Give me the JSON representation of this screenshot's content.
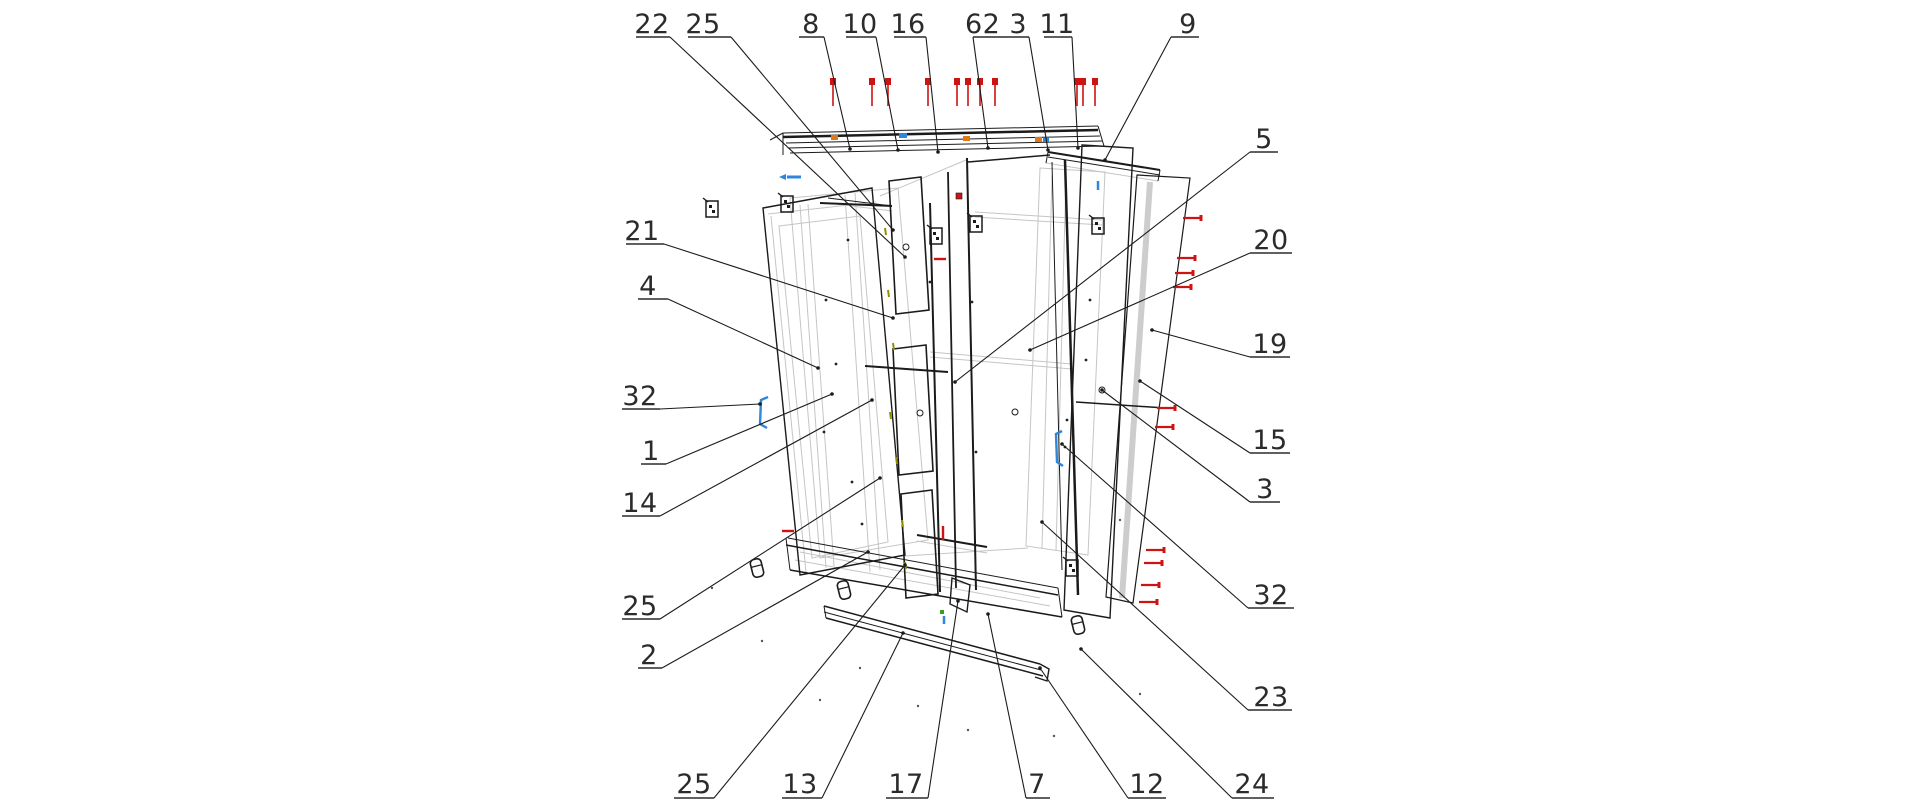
{
  "meta": {
    "width": 1916,
    "height": 804,
    "description": "Exploded assembly diagram of a sliding-door wardrobe cabinet with numbered part callouts"
  },
  "palette": {
    "line": "#1b1b1b",
    "ghost": "#c5c5c5",
    "band": "#cdcdcd",
    "red": "#cc1414",
    "blue": "#2e86de",
    "orange": "#e07818",
    "olive": "#8f9000",
    "green": "#3a9d23",
    "label": "#2b2b2b"
  },
  "callouts": [
    {
      "label": "22",
      "tx": 652,
      "ty": 33,
      "ul": [
        636,
        670,
        37
      ],
      "leaders": [
        [
          670,
          37,
          905,
          257
        ]
      ]
    },
    {
      "label": "25",
      "tx": 703,
      "ty": 33,
      "ul": [
        688,
        731,
        37
      ],
      "leaders": [
        [
          731,
          37,
          893,
          230
        ]
      ]
    },
    {
      "label": "8",
      "tx": 811,
      "ty": 33,
      "ul": [
        799,
        824,
        37
      ],
      "leaders": [
        [
          824,
          37,
          850,
          149
        ]
      ]
    },
    {
      "label": "10",
      "tx": 860,
      "ty": 33,
      "ul": [
        846,
        876,
        37
      ],
      "leaders": [
        [
          876,
          37,
          898,
          150
        ]
      ]
    },
    {
      "label": "16",
      "tx": 908,
      "ty": 33,
      "ul": [
        894,
        926,
        37
      ],
      "leaders": [
        [
          926,
          37,
          938,
          152
        ]
      ]
    },
    {
      "label": "62 3",
      "tx": 996,
      "ty": 33,
      "ul": [
        973,
        1029,
        37
      ],
      "leaders": [
        [
          973,
          37,
          988,
          148
        ],
        [
          1029,
          37,
          1048,
          150
        ]
      ]
    },
    {
      "label": "11",
      "tx": 1057,
      "ty": 33,
      "ul": [
        1044,
        1072,
        37
      ],
      "leaders": [
        [
          1072,
          37,
          1078,
          148
        ]
      ]
    },
    {
      "label": "9",
      "tx": 1188,
      "ty": 33,
      "ul": [
        1171,
        1199,
        37
      ],
      "leaders": [
        [
          1171,
          37,
          1105,
          160
        ]
      ]
    },
    {
      "label": "21",
      "tx": 642,
      "ty": 240,
      "ul": [
        626,
        664,
        244
      ],
      "leaders": [
        [
          664,
          244,
          893,
          318
        ]
      ]
    },
    {
      "label": "4",
      "tx": 648,
      "ty": 295,
      "ul": [
        638,
        668,
        299
      ],
      "leaders": [
        [
          668,
          299,
          818,
          368
        ]
      ]
    },
    {
      "label": "32",
      "tx": 640,
      "ty": 405,
      "ul": [
        622,
        660,
        409
      ],
      "leaders": [
        [
          660,
          409,
          760,
          404
        ]
      ]
    },
    {
      "label": "1",
      "tx": 651,
      "ty": 460,
      "ul": [
        641,
        666,
        464
      ],
      "leaders": [
        [
          666,
          464,
          832,
          394
        ]
      ]
    },
    {
      "label": "14",
      "tx": 640,
      "ty": 512,
      "ul": [
        622,
        660,
        516
      ],
      "leaders": [
        [
          660,
          516,
          872,
          400
        ]
      ]
    },
    {
      "label": "25",
      "tx": 640,
      "ty": 615,
      "ul": [
        622,
        660,
        619
      ],
      "leaders": [
        [
          660,
          619,
          880,
          478
        ]
      ]
    },
    {
      "label": "2",
      "tx": 649,
      "ty": 664,
      "ul": [
        638,
        662,
        668
      ],
      "leaders": [
        [
          662,
          668,
          868,
          552
        ]
      ]
    },
    {
      "label": "5",
      "tx": 1264,
      "ty": 148,
      "ul": [
        1250,
        1278,
        152
      ],
      "leaders": [
        [
          1250,
          152,
          955,
          382
        ]
      ]
    },
    {
      "label": "20",
      "tx": 1271,
      "ty": 249,
      "ul": [
        1250,
        1292,
        253
      ],
      "leaders": [
        [
          1250,
          253,
          1030,
          350
        ]
      ]
    },
    {
      "label": "19",
      "tx": 1270,
      "ty": 353,
      "ul": [
        1250,
        1290,
        357
      ],
      "leaders": [
        [
          1250,
          357,
          1152,
          330
        ]
      ]
    },
    {
      "label": "15",
      "tx": 1270,
      "ty": 449,
      "ul": [
        1250,
        1290,
        453
      ],
      "leaders": [
        [
          1250,
          453,
          1140,
          381
        ]
      ]
    },
    {
      "label": "3",
      "tx": 1265,
      "ty": 498,
      "ul": [
        1250,
        1280,
        502
      ],
      "leaders": [
        [
          1250,
          502,
          1102,
          390
        ]
      ]
    },
    {
      "label": "32",
      "tx": 1271,
      "ty": 604,
      "ul": [
        1248,
        1294,
        608
      ],
      "leaders": [
        [
          1248,
          608,
          1062,
          444
        ]
      ]
    },
    {
      "label": "23",
      "tx": 1271,
      "ty": 706,
      "ul": [
        1248,
        1292,
        710
      ],
      "leaders": [
        [
          1248,
          710,
          1042,
          522
        ]
      ]
    },
    {
      "label": "25",
      "tx": 694,
      "ty": 793,
      "ul": [
        674,
        714,
        798
      ],
      "leaders": [
        [
          714,
          798,
          905,
          565
        ]
      ]
    },
    {
      "label": "13",
      "tx": 800,
      "ty": 793,
      "ul": [
        782,
        822,
        798
      ],
      "leaders": [
        [
          822,
          798,
          903,
          633
        ]
      ]
    },
    {
      "label": "17",
      "tx": 906,
      "ty": 793,
      "ul": [
        886,
        928,
        798
      ],
      "leaders": [
        [
          928,
          798,
          958,
          601
        ]
      ]
    },
    {
      "label": "7",
      "tx": 1037,
      "ty": 793,
      "ul": [
        1026,
        1050,
        798
      ],
      "leaders": [
        [
          1026,
          798,
          988,
          614
        ]
      ]
    },
    {
      "label": "12",
      "tx": 1147,
      "ty": 793,
      "ul": [
        1128,
        1166,
        798
      ],
      "leaders": [
        [
          1128,
          798,
          1040,
          668
        ]
      ]
    },
    {
      "label": "24",
      "tx": 1252,
      "ty": 793,
      "ul": [
        1232,
        1274,
        798
      ],
      "leaders": [
        [
          1232,
          798,
          1081,
          649
        ]
      ]
    }
  ],
  "drawing": {
    "ghost_polys": [
      {
        "name": "left-door-back-panel",
        "pts": [
          [
            790,
            198
          ],
          [
            898,
            188
          ],
          [
            928,
            540
          ],
          [
            820,
            558
          ]
        ],
        "w": 1
      },
      {
        "name": "left-door-inner-frame",
        "pts": [
          [
            779,
            226
          ],
          [
            860,
            216
          ],
          [
            888,
            542
          ],
          [
            812,
            558
          ]
        ],
        "w": 1
      },
      {
        "name": "right-back-panel",
        "pts": [
          [
            1040,
            168
          ],
          [
            1105,
            172
          ],
          [
            1088,
            555
          ],
          [
            1026,
            546
          ]
        ],
        "w": 1
      }
    ],
    "ghost_lines": [
      [
        771,
        216,
        806,
        572,
        1
      ],
      [
        768,
        214,
        876,
        202,
        1
      ],
      [
        800,
        205,
        826,
        568,
        1
      ],
      [
        808,
        204,
        834,
        566,
        1
      ],
      [
        845,
        195,
        870,
        572,
        1
      ],
      [
        855,
        193,
        880,
        570,
        1
      ],
      [
        880,
        196,
        966,
        160,
        1
      ],
      [
        905,
        556,
        1028,
        548,
        1
      ],
      [
        930,
        352,
        1072,
        364,
        1
      ],
      [
        930,
        357,
        1072,
        369,
        1
      ],
      [
        975,
        212,
        1102,
        220,
        1
      ],
      [
        975,
        217,
        1102,
        225,
        1
      ],
      [
        1052,
        175,
        1042,
        548,
        1
      ],
      [
        1066,
        176,
        1056,
        550,
        1
      ],
      [
        800,
        552,
        1040,
        598,
        1
      ],
      [
        795,
        560,
        1050,
        606,
        1
      ],
      [
        828,
        203,
        892,
        211,
        1
      ],
      [
        917,
        541,
        987,
        553,
        1
      ],
      [
        1150,
        182,
        1122,
        598,
        6
      ],
      [
        1046,
        163,
        1158,
        181,
        1
      ]
    ],
    "polys": [
      {
        "name": "left-side-panel",
        "pts": [
          [
            763,
            208
          ],
          [
            872,
            188
          ],
          [
            905,
            555
          ],
          [
            800,
            575
          ]
        ],
        "w": 1.4
      },
      {
        "name": "filler-panel-top",
        "pts": [
          [
            889,
            181
          ],
          [
            921,
            177
          ],
          [
            929,
            310
          ],
          [
            896,
            314
          ]
        ],
        "w": 1.6
      },
      {
        "name": "filler-panel-mid",
        "pts": [
          [
            893,
            349
          ],
          [
            926,
            345
          ],
          [
            933,
            471
          ],
          [
            899,
            475
          ]
        ],
        "w": 1.6
      },
      {
        "name": "filler-panel-bottom",
        "pts": [
          [
            901,
            494
          ],
          [
            932,
            490
          ],
          [
            938,
            594
          ],
          [
            906,
            598
          ]
        ],
        "w": 1.6
      },
      {
        "name": "right-side-panel",
        "pts": [
          [
            1082,
            145
          ],
          [
            1133,
            148
          ],
          [
            1110,
            618
          ],
          [
            1064,
            610
          ]
        ],
        "w": 1.4
      },
      {
        "name": "right-door-panel",
        "pts": [
          [
            1137,
            175
          ],
          [
            1190,
            178
          ],
          [
            1133,
            603
          ],
          [
            1106,
            597
          ]
        ],
        "w": 1.2
      },
      {
        "name": "bottom-bracket-piece",
        "pts": [
          [
            952,
            578
          ],
          [
            970,
            585
          ],
          [
            967,
            612
          ],
          [
            950,
            604
          ]
        ],
        "w": 1.4
      }
    ],
    "lines": [
      [
        783,
        133,
        1098,
        126,
        1
      ],
      [
        783,
        137,
        1098,
        130,
        2.5
      ],
      [
        786,
        143,
        1100,
        136,
        1
      ],
      [
        790,
        153,
        1104,
        146,
        1
      ],
      [
        783,
        133,
        783,
        155,
        1
      ],
      [
        770,
        140,
        783,
        133,
        1
      ],
      [
        1098,
        126,
        1104,
        146,
        1
      ],
      [
        788,
        148,
        1102,
        141,
        1
      ],
      [
        1048,
        152,
        1160,
        170,
        2
      ],
      [
        1048,
        157,
        1160,
        175,
        1
      ],
      [
        1048,
        152,
        1046,
        163,
        1
      ],
      [
        1160,
        170,
        1158,
        181,
        1
      ],
      [
        930,
        203,
        940,
        592,
        2
      ],
      [
        967,
        158,
        976,
        590,
        2
      ],
      [
        1065,
        160,
        1078,
        595,
        2.5
      ],
      [
        948,
        172,
        956,
        588,
        1.8
      ],
      [
        1052,
        162,
        1062,
        570,
        1
      ],
      [
        968,
        162,
        1050,
        155,
        1.5
      ],
      [
        820,
        203,
        892,
        206,
        2
      ],
      [
        828,
        198,
        892,
        206,
        1
      ],
      [
        865,
        366,
        948,
        372,
        2
      ],
      [
        1076,
        402,
        1165,
        408,
        1.5
      ],
      [
        917,
        535,
        987,
        547,
        2
      ],
      [
        788,
        538,
        1058,
        588,
        1
      ],
      [
        786,
        545,
        1058,
        595,
        1.5
      ],
      [
        790,
        570,
        1062,
        617,
        1.5
      ],
      [
        786,
        538,
        790,
        570,
        1
      ],
      [
        1058,
        588,
        1062,
        617,
        1
      ],
      [
        824,
        606,
        1040,
        664,
        1.5
      ],
      [
        824,
        612,
        1041,
        670,
        1
      ],
      [
        826,
        618,
        1043,
        676,
        1.5
      ],
      [
        824,
        606,
        826,
        618,
        1
      ]
    ],
    "polylines": [
      {
        "name": "bottom-track-end-hook",
        "pts": [
          [
            1040,
            664
          ],
          [
            1049,
            669
          ],
          [
            1047,
            681
          ],
          [
            1035,
            677
          ]
        ],
        "w": 1.4
      }
    ],
    "screws_top": [
      833,
      872,
      888,
      928,
      957,
      968,
      980,
      995,
      1077,
      1083,
      1095
    ],
    "screws_right": [
      [
        1183,
        218
      ],
      [
        1177,
        258
      ],
      [
        1175,
        273
      ],
      [
        1173,
        287
      ],
      [
        1157,
        408
      ],
      [
        1155,
        427
      ],
      [
        1146,
        550
      ],
      [
        1144,
        563
      ],
      [
        1141,
        585
      ],
      [
        1139,
        602
      ]
    ],
    "red_misc": {
      "square": [
        956,
        193,
        6,
        6
      ],
      "h_ticks": [
        [
          934,
          259,
          12
        ],
        [
          782,
          531,
          12
        ]
      ],
      "v_ticks": [
        [
          943,
          526,
          14
        ]
      ]
    },
    "blue_parts": {
      "handles": [
        [
          [
            768,
            397
          ],
          [
            761,
            400
          ],
          [
            760,
            424
          ],
          [
            767,
            428
          ]
        ],
        [
          [
            1062,
            431
          ],
          [
            1056,
            434
          ],
          [
            1057,
            462
          ],
          [
            1063,
            466
          ]
        ]
      ],
      "arrow_line": [
        787,
        177,
        801,
        177
      ],
      "arrow_head": [
        [
          786,
          174
        ],
        [
          786,
          180
        ],
        [
          779,
          177
        ]
      ],
      "v_ticks": [
        [
          1098,
          181,
          9
        ],
        [
          944,
          616,
          8
        ]
      ],
      "clips": [
        [
          899,
          133,
          8,
          5
        ],
        [
          1043,
          138,
          6,
          4
        ]
      ]
    },
    "orange_clips": [
      [
        831,
        135,
        7,
        5
      ],
      [
        963,
        136,
        7,
        5
      ],
      [
        1035,
        137,
        7,
        5
      ]
    ],
    "green_dots": [
      [
        940,
        610,
        4,
        4
      ]
    ],
    "olive_ticks": [
      [
        885,
        228
      ],
      [
        888,
        290
      ],
      [
        893,
        343
      ],
      [
        890,
        412
      ],
      [
        896,
        457
      ],
      [
        902,
        520
      ],
      [
        905,
        562
      ]
    ],
    "feet": [
      [
        757,
        568
      ],
      [
        844,
        590
      ],
      [
        1078,
        625
      ]
    ],
    "brackets": [
      [
        706,
        201
      ],
      [
        781,
        196
      ],
      [
        930,
        228
      ],
      [
        970,
        216
      ],
      [
        1092,
        218
      ],
      [
        1066,
        560
      ]
    ],
    "holes": [
      [
        826,
        300
      ],
      [
        836,
        364
      ],
      [
        824,
        432
      ],
      [
        852,
        482
      ],
      [
        862,
        524
      ],
      [
        848,
        240
      ],
      [
        1067,
        420
      ],
      [
        1065,
        447
      ],
      [
        1090,
        300
      ],
      [
        1086,
        360
      ],
      [
        930,
        282
      ],
      [
        972,
        302
      ],
      [
        976,
        452
      ]
    ],
    "rings": [
      [
        906,
        247
      ],
      [
        920,
        413
      ],
      [
        1102,
        390
      ],
      [
        1015,
        412
      ]
    ],
    "debris": [
      [
        712,
        588
      ],
      [
        762,
        641
      ],
      [
        918,
        706
      ],
      [
        1054,
        736
      ],
      [
        1140,
        694
      ],
      [
        860,
        668
      ],
      [
        968,
        730
      ],
      [
        820,
        700
      ],
      [
        1120,
        520
      ]
    ]
  }
}
